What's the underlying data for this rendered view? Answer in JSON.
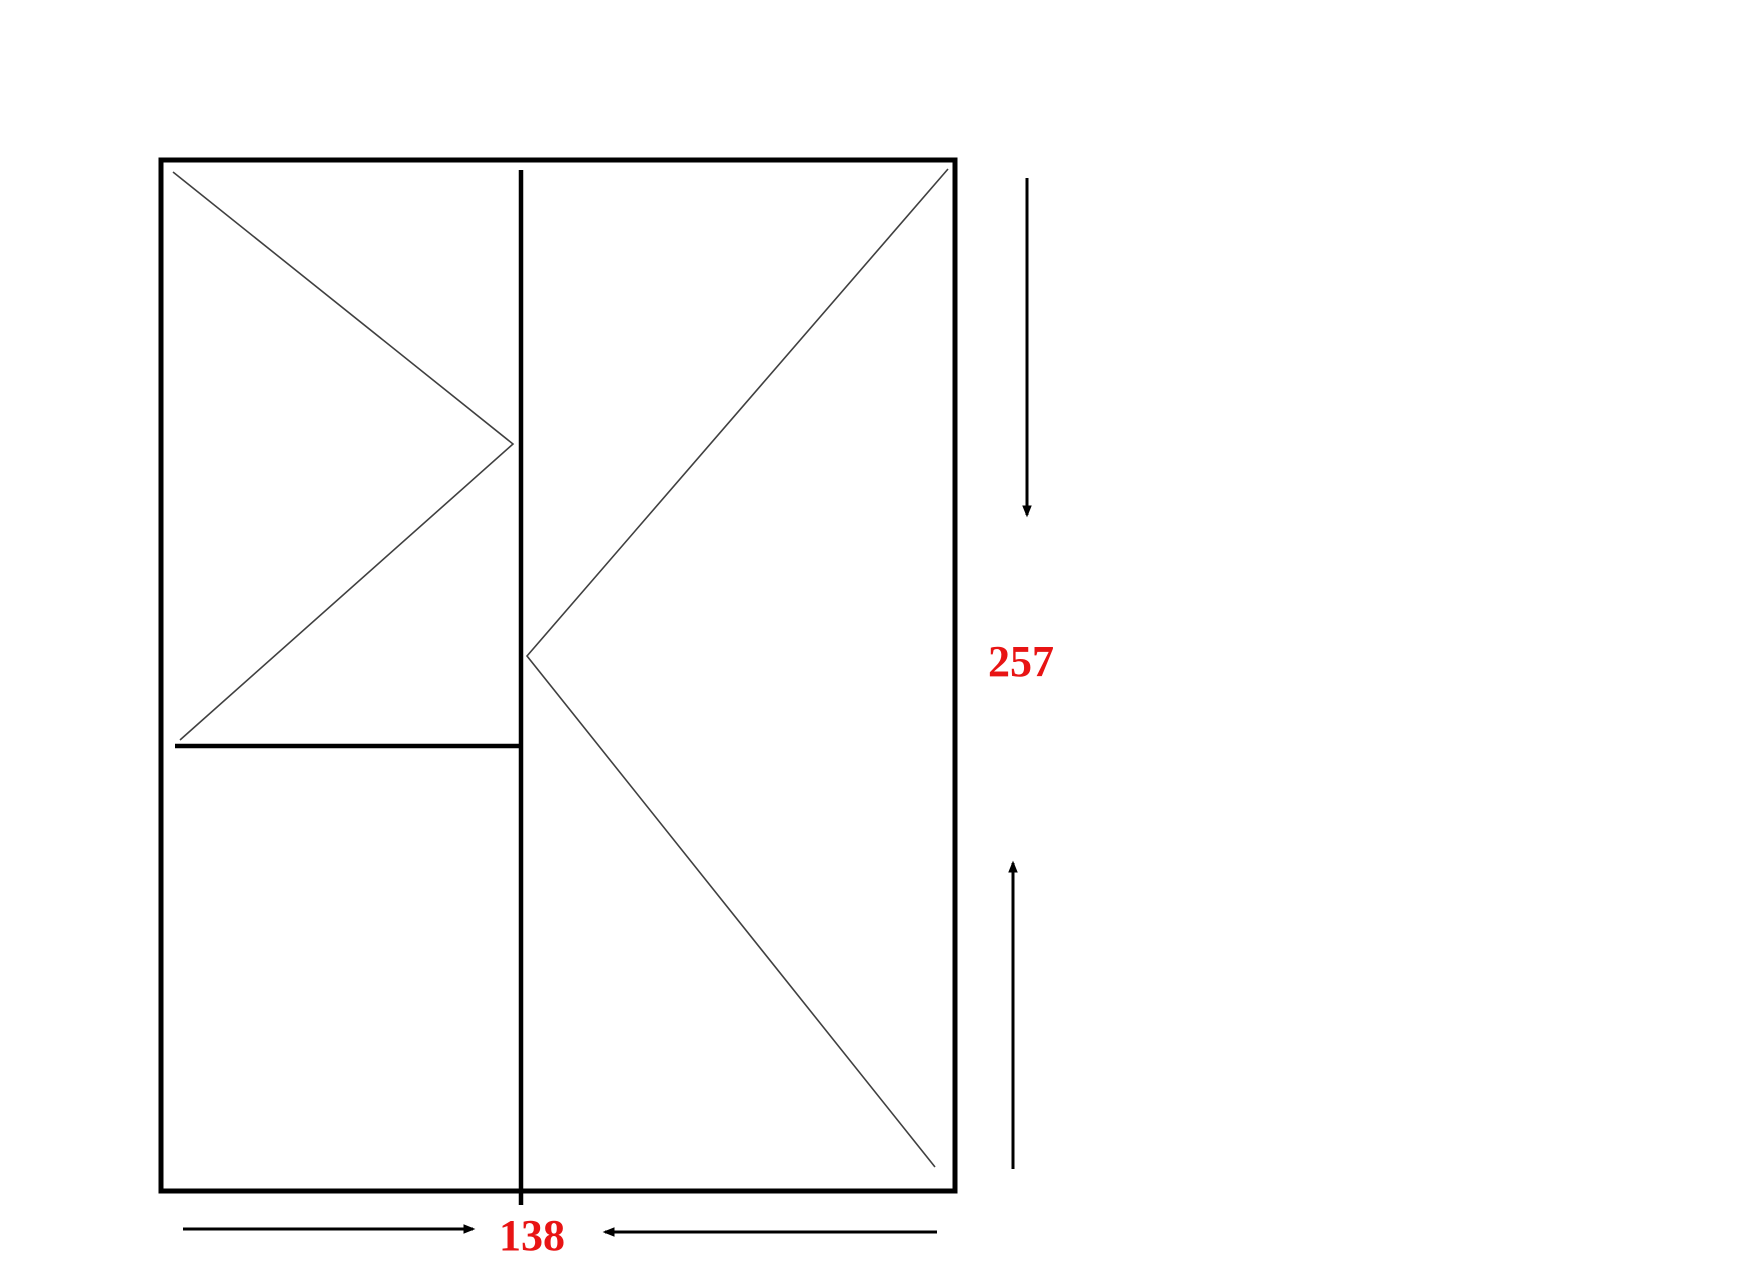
{
  "page": {
    "background": "#ffffff",
    "width": 1748,
    "height": 1287
  },
  "drawing": {
    "description": "Window elevation technical drawing with two panes, opening-direction symbols and dimension arrows",
    "colors": {
      "frame_line": "#000000",
      "symbol_line": "#404040",
      "dimension_line": "#000000",
      "dimension_text": "#e81414"
    },
    "frame": {
      "outer": {
        "x": 161,
        "y": 160,
        "width": 794,
        "height": 1031,
        "stroke_width": 5
      },
      "mullion": {
        "x": 521,
        "y1": 170,
        "y2": 1205,
        "stroke_width": 4.5
      },
      "transom": {
        "y": 746,
        "x1": 175,
        "x2": 523,
        "stroke_width": 4.5
      }
    },
    "opening_symbols": [
      {
        "name": "left-sash-opening-symbol",
        "points": [
          [
            173,
            172
          ],
          [
            513,
            444
          ],
          [
            180,
            740
          ]
        ],
        "stroke_width": 1.6
      },
      {
        "name": "right-sash-opening-symbol",
        "points": [
          [
            948,
            169
          ],
          [
            527,
            656
          ],
          [
            935,
            1167
          ]
        ],
        "stroke_width": 1.6
      }
    ],
    "dimensions": {
      "height": {
        "label": "257",
        "label_x": 1021,
        "label_baseline_y": 676,
        "arrow_down": {
          "x": 1027,
          "from_y": 178,
          "to_y": 515
        },
        "arrow_up": {
          "x": 1013,
          "from_y": 1169,
          "to_y": 863
        },
        "stroke_width": 3
      },
      "width": {
        "label": "138",
        "label_x": 532,
        "label_baseline_y": 1250,
        "arrow_right": {
          "y": 1229,
          "from_x": 183,
          "to_x": 473
        },
        "arrow_left": {
          "y": 1232,
          "from_x": 937,
          "to_x": 605
        },
        "stroke_width": 3
      }
    }
  }
}
